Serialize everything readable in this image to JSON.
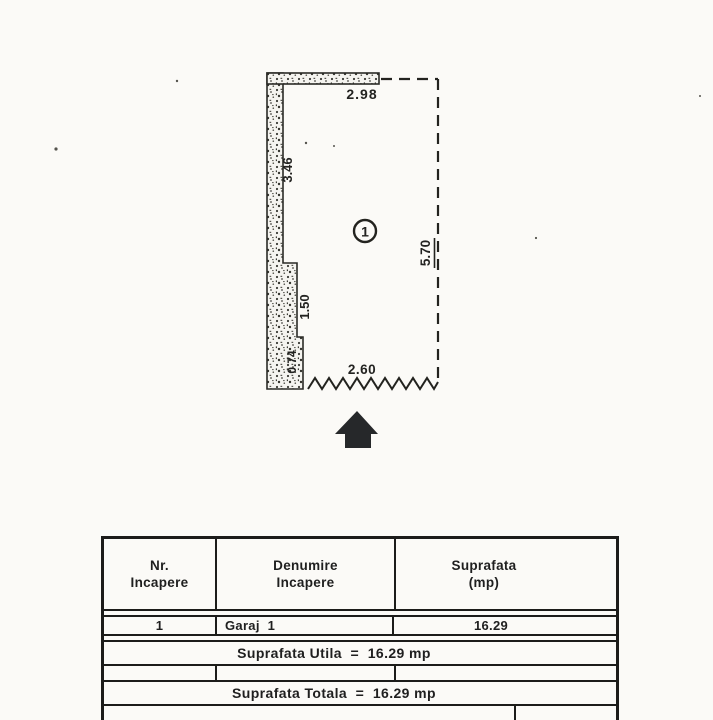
{
  "page": {
    "background": "#fbfaf7",
    "ink": "#1c1c1a",
    "arrow_fill": "#26282a"
  },
  "plan": {
    "room_label": "1",
    "dimensions": {
      "top": "2.98",
      "left_upper": "3.46",
      "left_middle": "1.50",
      "left_lower": "0.74",
      "bottom": "2.60",
      "right": "5.70"
    }
  },
  "table": {
    "headers": [
      {
        "line1": "Nr.",
        "line2": "Incapere"
      },
      {
        "line1": "Denumire",
        "line2": "Incapere"
      },
      {
        "line1": "Suprafata",
        "line2": "(mp)"
      }
    ],
    "rows": [
      {
        "nr": "1",
        "denumire": "Garaj  1",
        "suprafata": "16.29"
      }
    ],
    "summary_utila": "Suprafata Utila  =  16.29 mp",
    "summary_totala": "Suprafata Totala  =  16.29 mp"
  }
}
